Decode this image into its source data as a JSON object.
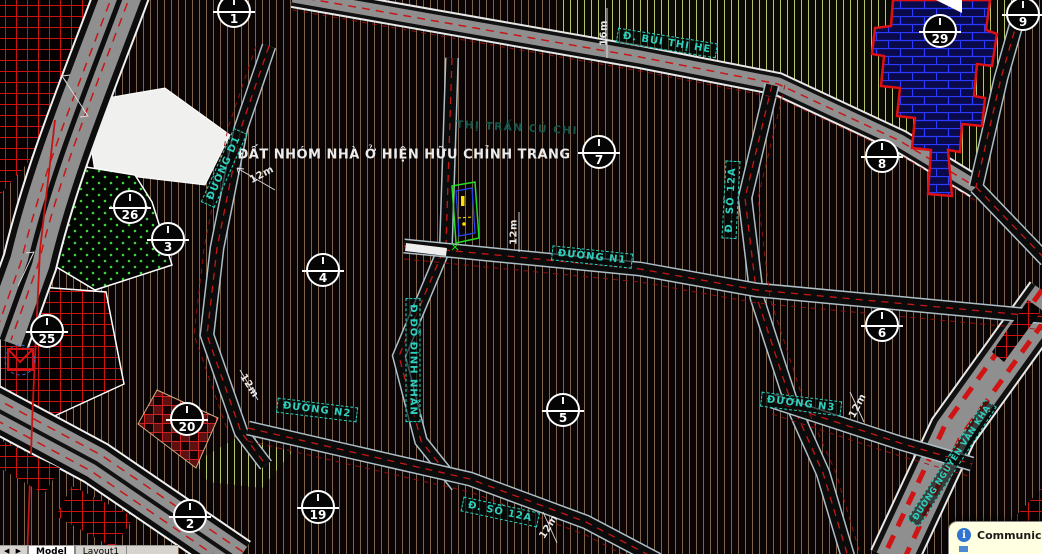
{
  "map": {
    "region_label": "THỊ TRẤN CỦ CHI",
    "title": "ĐẤT NHÓM NHÀ Ở HIỆN HỮU CHỈNH TRANG",
    "street_labels": [
      {
        "text": "Đ. BÙI THỊ HE"
      },
      {
        "text": "ĐƯỜNG D1"
      },
      {
        "text": "ĐƯỜNG N1"
      },
      {
        "text": "Đ.ĐỖ ĐÌNH NHÂN"
      },
      {
        "text": "Đ. SỐ 12A"
      },
      {
        "text": "ĐƯỜNG N2"
      },
      {
        "text": "ĐƯỜNG N3"
      },
      {
        "text": "Đ. SỐ 12A"
      },
      {
        "text": "ĐƯỜNG NGUYỄN VĂN KHẠ"
      }
    ],
    "dimensions": [
      {
        "text": "16m"
      },
      {
        "text": "12m"
      },
      {
        "text": "12m"
      },
      {
        "text": "12m"
      },
      {
        "text": "12m"
      },
      {
        "text": "12m"
      }
    ],
    "markers": [
      {
        "roman": "I",
        "number": "1"
      },
      {
        "roman": "I",
        "number": "7"
      },
      {
        "roman": "I",
        "number": "9"
      },
      {
        "roman": "I",
        "number": "29"
      },
      {
        "roman": "I",
        "number": "8"
      },
      {
        "roman": "I",
        "number": "26"
      },
      {
        "roman": "I",
        "number": "3"
      },
      {
        "roman": "I",
        "number": "4"
      },
      {
        "roman": "I",
        "number": "25"
      },
      {
        "roman": "I",
        "number": "20"
      },
      {
        "roman": "I",
        "number": "5"
      },
      {
        "roman": "I",
        "number": "6"
      },
      {
        "roman": "I",
        "number": "2"
      },
      {
        "roman": "I",
        "number": "19"
      }
    ],
    "colors": {
      "label_teal": "#2fd0bd",
      "faint_teal": "#15564c",
      "hatch_tan": "#7d6349",
      "hatch_yellow": "#b9c16b",
      "hatch_red": "#cc1111",
      "brick_blue": "#2a3aff",
      "road_red_dash": "#c81616",
      "dimension_white": "#e8e8e8"
    }
  },
  "statusbar": {
    "nav_prev_icon": "◀",
    "nav_next_icon": "▶",
    "tabs": [
      {
        "label": "Model"
      },
      {
        "label": "Layout1"
      }
    ]
  },
  "notification": {
    "info_icon_glyph": "i",
    "title": "Communic"
  }
}
